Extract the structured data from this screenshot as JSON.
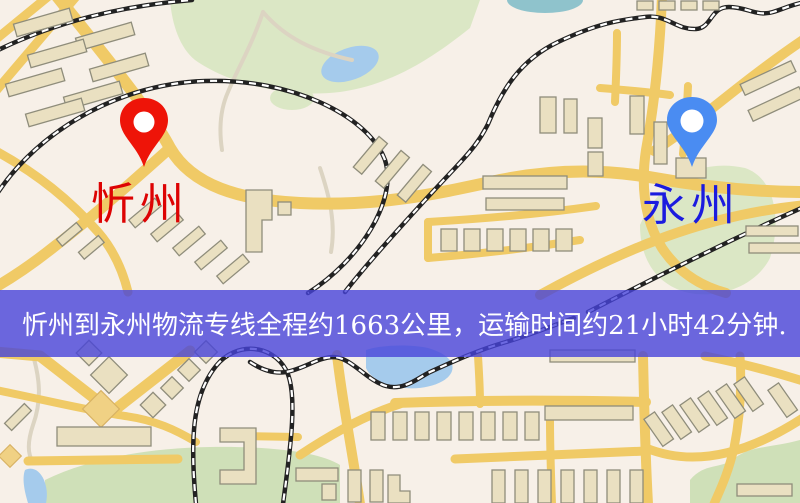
{
  "map": {
    "origin": {
      "name": "忻州"
    },
    "destination": {
      "name": "永州"
    },
    "banner": {
      "text": "忻州到永州物流专线全程约1663公里，运输时间约21小时42分钟."
    }
  },
  "css_vars": {
    "bg": "#f7f0e8",
    "park": "#dbe7c5",
    "park2": "#cfe0b8",
    "water": "#a5cbec",
    "teal": "#8fc3cc",
    "road": "#f0ca66",
    "bfill": "#eae0c1",
    "bstroke": "#8f8d7b",
    "byellow": "#f0d184",
    "rail": "#222222",
    "raildash": "#ffffff",
    "thinroad": "#dcd4c2",
    "banner": "rgba(71,67,217,0.80)",
    "bannertext": "#ffffff",
    "pinred": "#ee1408",
    "labelred": "#dd0303",
    "pinblue": "#4a8cf2",
    "labelblue": "#1b1bdf"
  }
}
